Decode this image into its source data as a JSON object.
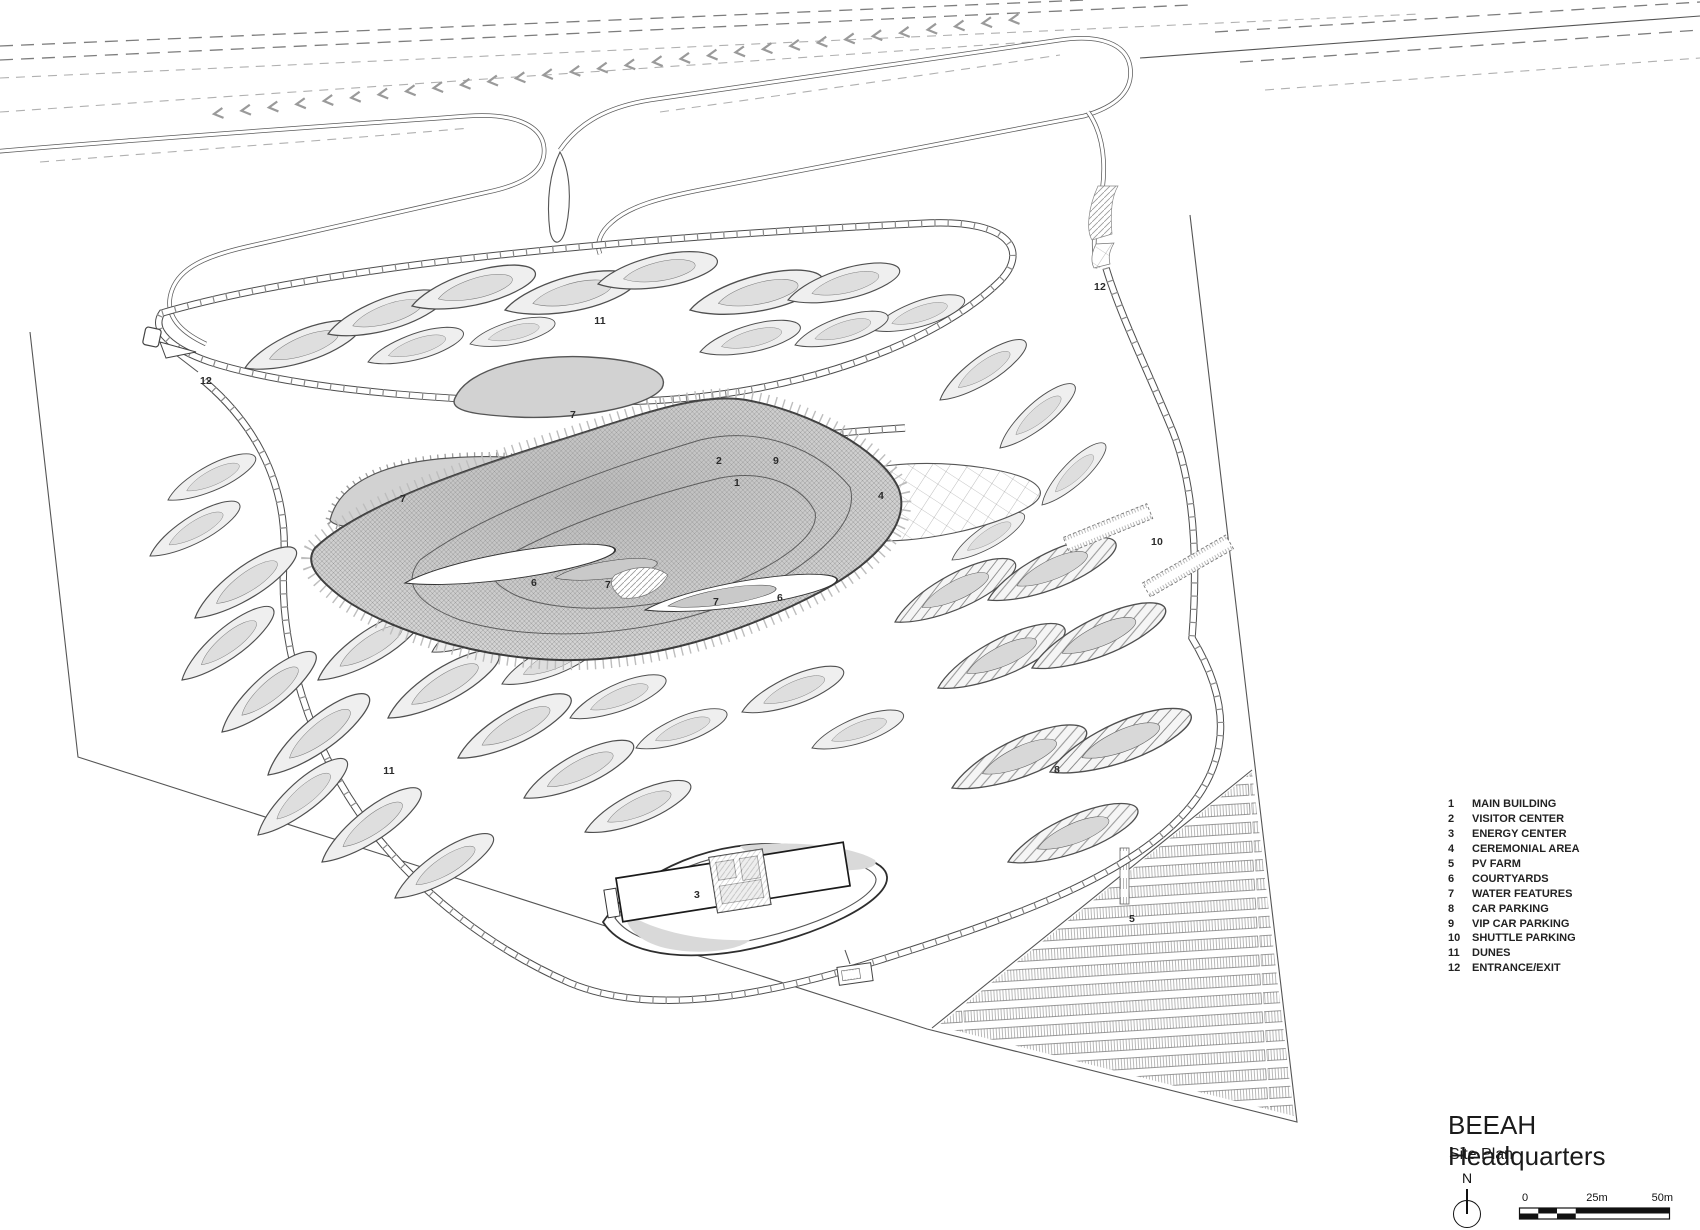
{
  "title_block": {
    "title": "BEEAH Headquarters",
    "subtitle": "Site Plan",
    "north_label": "N",
    "scale_labels": {
      "start": "0",
      "mid": "25m",
      "end": "50m"
    }
  },
  "legend": {
    "items": [
      {
        "num": "1",
        "label": "MAIN BUILDING"
      },
      {
        "num": "2",
        "label": "VISITOR CENTER"
      },
      {
        "num": "3",
        "label": "ENERGY CENTER"
      },
      {
        "num": "4",
        "label": "CEREMONIAL AREA"
      },
      {
        "num": "5",
        "label": "PV FARM"
      },
      {
        "num": "6",
        "label": "COURTYARDS"
      },
      {
        "num": "7",
        "label": "WATER FEATURES"
      },
      {
        "num": "8",
        "label": "CAR PARKING"
      },
      {
        "num": "9",
        "label": "VIP CAR PARKING"
      },
      {
        "num": "10",
        "label": "SHUTTLE PARKING"
      },
      {
        "num": "11",
        "label": "DUNES"
      },
      {
        "num": "12",
        "label": "ENTRANCE/EXIT"
      }
    ]
  },
  "plan_labels": [
    {
      "text": "11",
      "x": 600,
      "y": 321
    },
    {
      "text": "12",
      "x": 1100,
      "y": 287
    },
    {
      "text": "12",
      "x": 206,
      "y": 381
    },
    {
      "text": "7",
      "x": 573,
      "y": 415
    },
    {
      "text": "2",
      "x": 719,
      "y": 461
    },
    {
      "text": "9",
      "x": 776,
      "y": 461
    },
    {
      "text": "1",
      "x": 737,
      "y": 483
    },
    {
      "text": "4",
      "x": 881,
      "y": 496
    },
    {
      "text": "7",
      "x": 403,
      "y": 499
    },
    {
      "text": "10",
      "x": 1157,
      "y": 542
    },
    {
      "text": "6",
      "x": 534,
      "y": 583
    },
    {
      "text": "7",
      "x": 608,
      "y": 585
    },
    {
      "text": "7",
      "x": 716,
      "y": 602
    },
    {
      "text": "6",
      "x": 780,
      "y": 598
    },
    {
      "text": "8",
      "x": 1057,
      "y": 770
    },
    {
      "text": "11",
      "x": 389,
      "y": 771
    },
    {
      "text": "3",
      "x": 697,
      "y": 895
    },
    {
      "text": "5",
      "x": 1132,
      "y": 919
    }
  ],
  "colors": {
    "line": "#4c4c4c",
    "dune_fill": "#efefef",
    "water_fill": "#d2d2d2",
    "building_fill": "#d6d6d6"
  }
}
